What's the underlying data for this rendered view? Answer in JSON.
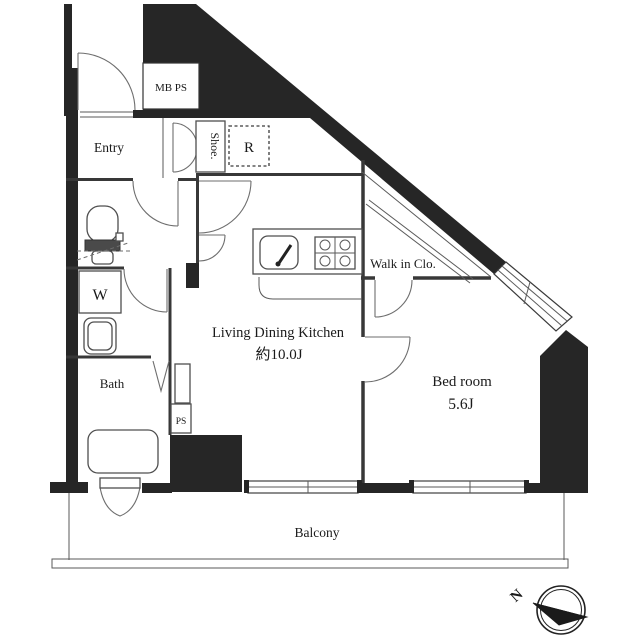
{
  "title": "apartment-floorplan",
  "rooms": {
    "entry": {
      "label": "Entry"
    },
    "ldk": {
      "label": "Living Dining Kitchen",
      "size": "約10.0J"
    },
    "bedroom": {
      "label": "Bed room",
      "size": "5.6J"
    },
    "walk_in_closet": {
      "label": "Walk in Clo."
    },
    "bath": {
      "label": "Bath"
    },
    "washer": {
      "label": "W"
    },
    "balcony": {
      "label": "Balcony"
    }
  },
  "fixtures": {
    "meter_pipe_space": {
      "label": "MB PS"
    },
    "shoe_cabinet": {
      "label": "Shoe."
    },
    "refrigerator": {
      "label": "R"
    },
    "pipe_space": {
      "label": "PS"
    }
  },
  "compass": {
    "north_label": "N"
  },
  "colors": {
    "wall": "#262626",
    "line": "#3a3a3a",
    "paper": "#ffffff"
  }
}
